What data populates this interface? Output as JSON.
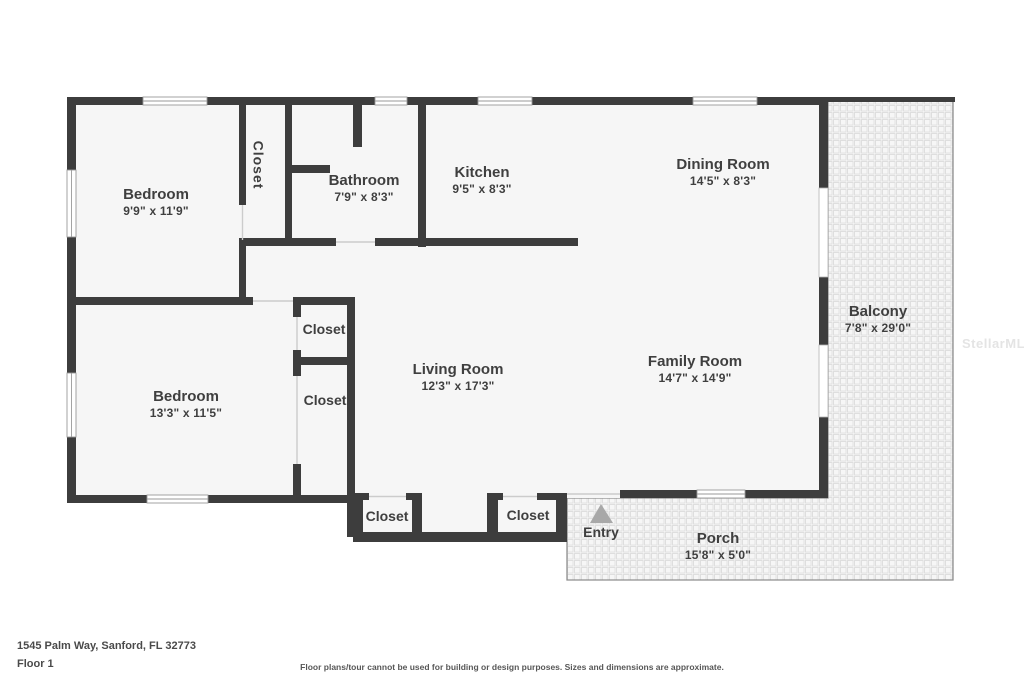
{
  "floorplan": {
    "watermark": "StellarMLS",
    "rooms": [
      {
        "name": "Bedroom",
        "dims": "9'9\" x 11'9\""
      },
      {
        "name": "Closet",
        "dims": ""
      },
      {
        "name": "Bathroom",
        "dims": "7'9\" x 8'3\""
      },
      {
        "name": "Kitchen",
        "dims": "9'5\" x 8'3\""
      },
      {
        "name": "Dining Room",
        "dims": "14'5\" x 8'3\""
      },
      {
        "name": "Balcony",
        "dims": "7'8\" x 29'0\""
      },
      {
        "name": "Bedroom",
        "dims": "13'3\" x 11'5\""
      },
      {
        "name": "Closet",
        "dims": ""
      },
      {
        "name": "Closet",
        "dims": ""
      },
      {
        "name": "Living Room",
        "dims": "12'3\" x 17'3\""
      },
      {
        "name": "Family Room",
        "dims": "14'7\" x 14'9\""
      },
      {
        "name": "Closet",
        "dims": ""
      },
      {
        "name": "Closet",
        "dims": ""
      },
      {
        "name": "Entry",
        "dims": ""
      },
      {
        "name": "Porch",
        "dims": "15'8\" x 5'0\""
      }
    ]
  },
  "footer": {
    "address": "1545 Palm Way, Sanford, FL 32773",
    "floor_label": "Floor 1",
    "disclaimer": "Floor plans/tour cannot be used for building or design purposes. Sizes and dimensions are approximate."
  },
  "colors": {
    "wall": "#3d3d3d",
    "floor": "#f6f6f6",
    "hatch_line": "#dedede",
    "entry_arrow": "#a8a8a8",
    "text": "#3f3f3f"
  }
}
